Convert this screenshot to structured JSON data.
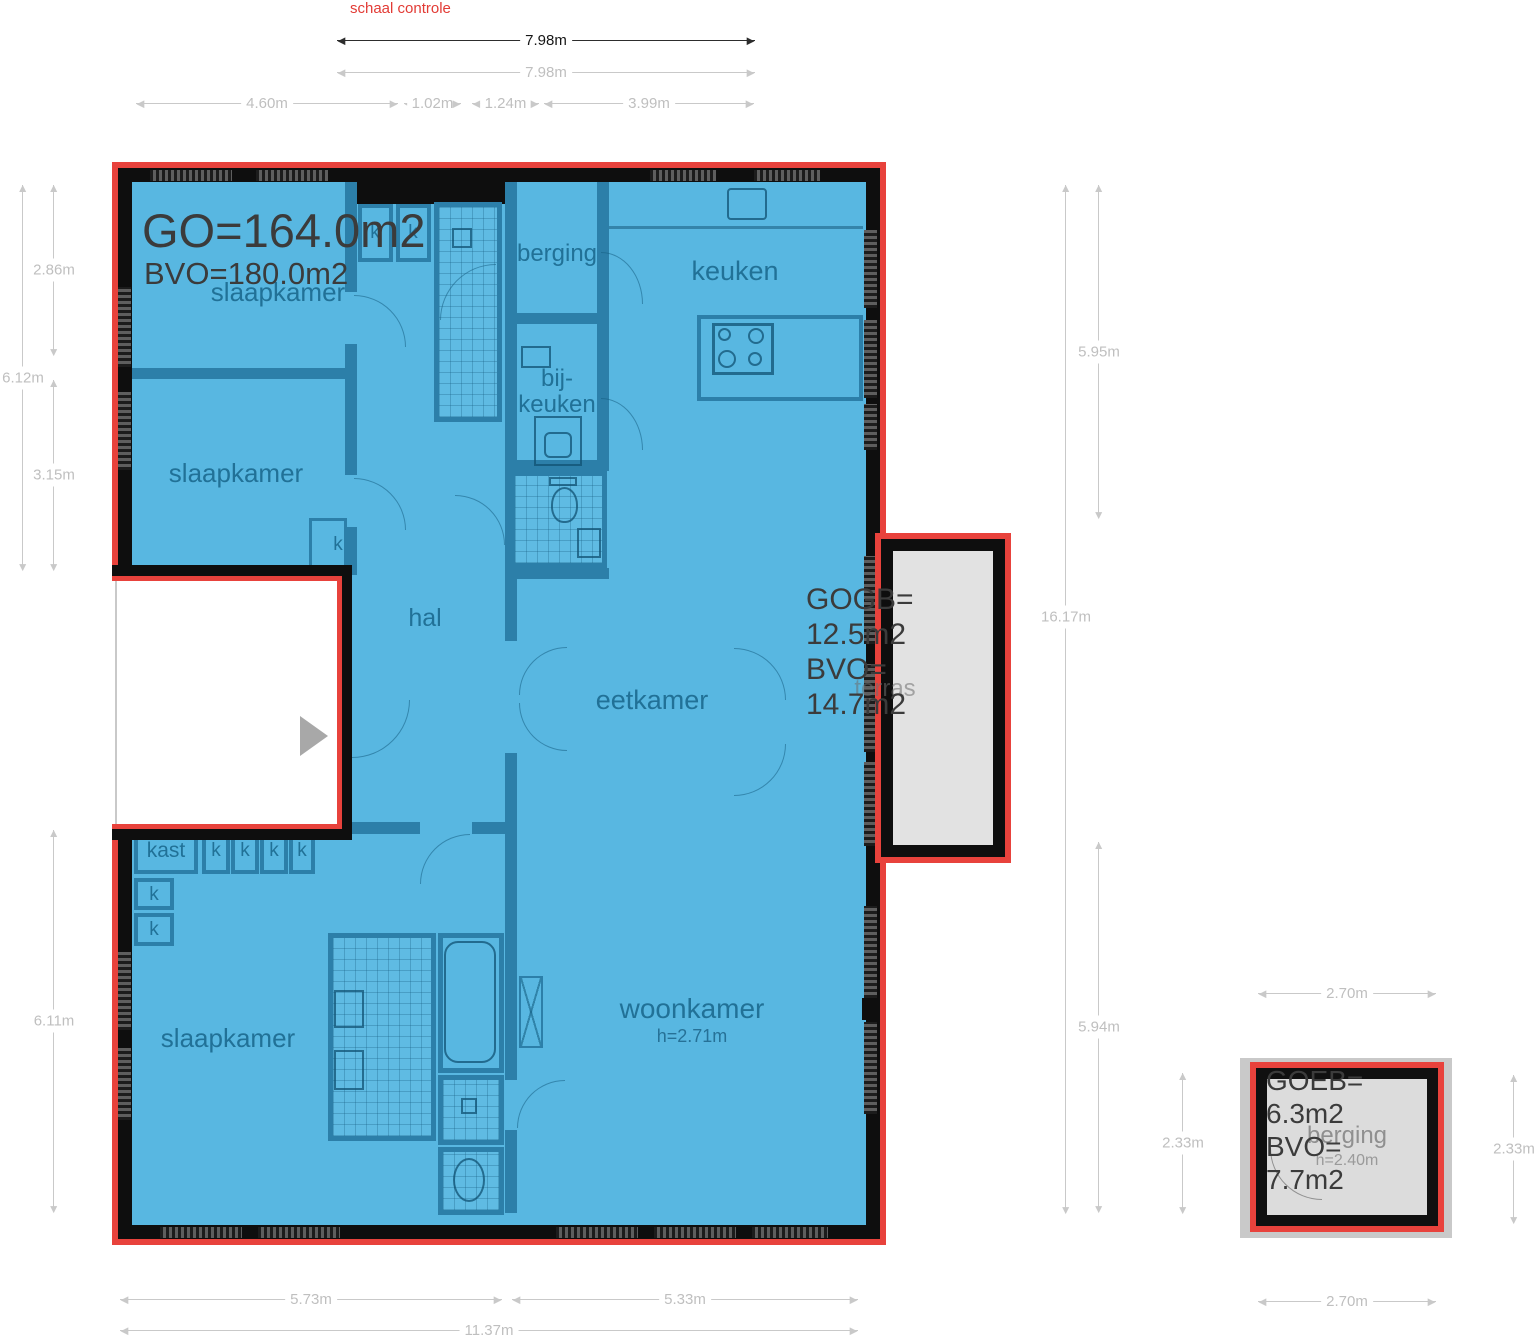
{
  "note": {
    "scale_check": "schaal controle"
  },
  "main_area": {
    "go": "GO=164.0m2",
    "bvo": "BVO=180.0m2",
    "woonkamer_height": "h=2.71m"
  },
  "terras_area": {
    "l1": "GOGB=",
    "l2": "12.5m2",
    "l3": "BVO=",
    "l4": "14.7m2"
  },
  "ext_area": {
    "l1": "GOEB=",
    "l2": "6.3m2",
    "l3": "BVO=",
    "l4": "7.7m2",
    "height": "h=2.40m"
  },
  "rooms": {
    "slaapkamer": "slaapkamer",
    "berging": "berging",
    "keuken": "keuken",
    "bij1": "bij-",
    "bij2": "keuken",
    "hal": "hal",
    "eetkamer": "eetkamer",
    "woonkamer": "woonkamer",
    "kast": "kast",
    "k": "k",
    "terras": "terras",
    "berging_ext": "berging"
  },
  "dims": {
    "top_dark": "7.98m",
    "top_gray": "7.98m",
    "t1": "4.60m",
    "t2": "1.02m",
    "t3": "1.24m",
    "t4": "3.99m",
    "l1": "2.86m",
    "l2": "6.12m",
    "l3": "3.15m",
    "l4": "6.11m",
    "r1": "5.95m",
    "r2": "16.17m",
    "r3": "5.94m",
    "r4": "2.33m",
    "b1": "5.73m",
    "b2": "5.33m",
    "b3": "11.37m",
    "eb_top": "2.70m",
    "eb_right": "2.33m",
    "eb_bottom": "2.70m"
  },
  "colors": {
    "outline_red": "#e8423c",
    "floor_blue": "#58b7e1",
    "wall_black": "#0e0e0e",
    "partition_teal": "#2c7fa9"
  }
}
